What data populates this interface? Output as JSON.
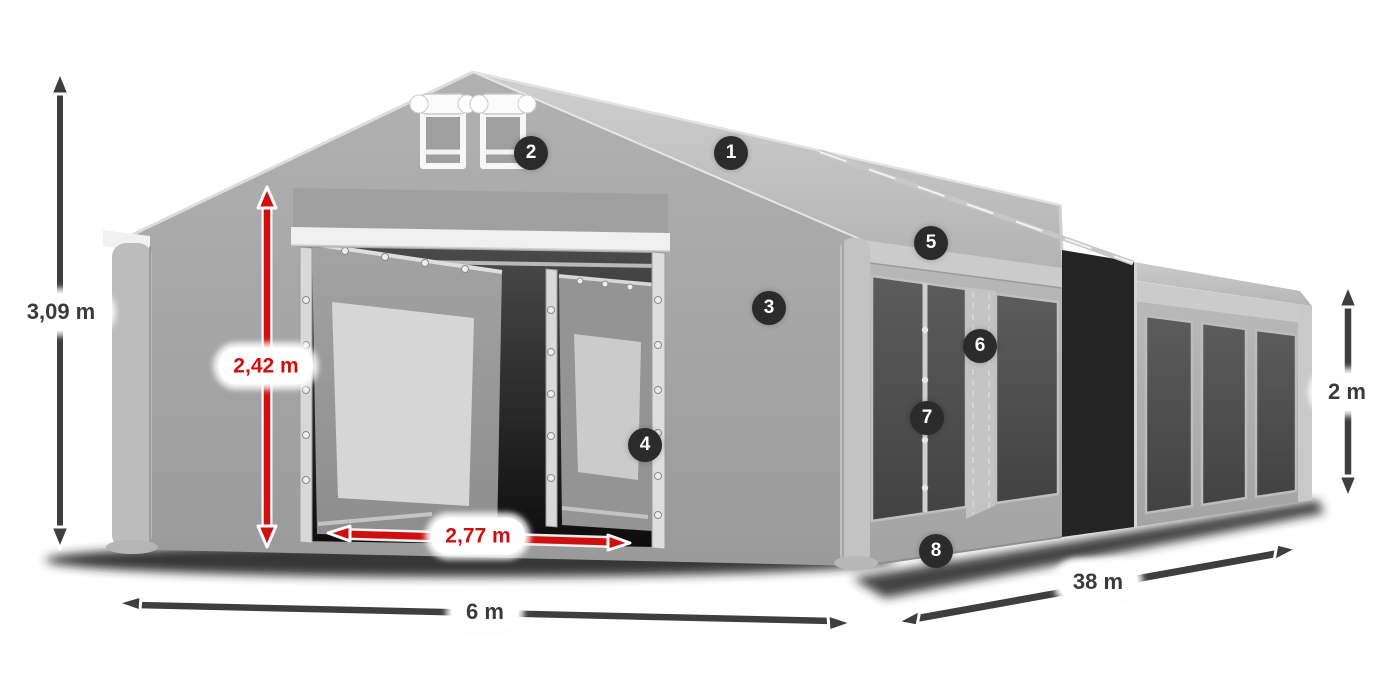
{
  "page": {
    "background": "#ffffff"
  },
  "colors": {
    "accent_red": "#d01010",
    "arrow_dark": "#3e3e3e",
    "badge_bg": "#2b2b2b",
    "badge_text": "#ffffff",
    "pill_bg": "#ffffff",
    "pill_text_dark": "#3a3a3a",
    "tent_gray": "#adadad",
    "window_gray": "#4e4e4e"
  },
  "dimensions": {
    "total_height": {
      "label": "3,09 m"
    },
    "entrance_height": {
      "label": "2,42 m"
    },
    "entrance_width": {
      "label": "2,77 m"
    },
    "front_width": {
      "label": "6 m"
    },
    "side_length": {
      "label": "38 m"
    },
    "side_wall_height": {
      "label": "2 m"
    }
  },
  "hotspots": [
    {
      "number": "1"
    },
    {
      "number": "2"
    },
    {
      "number": "3"
    },
    {
      "number": "4"
    },
    {
      "number": "5"
    },
    {
      "number": "6"
    },
    {
      "number": "7"
    },
    {
      "number": "8"
    }
  ]
}
